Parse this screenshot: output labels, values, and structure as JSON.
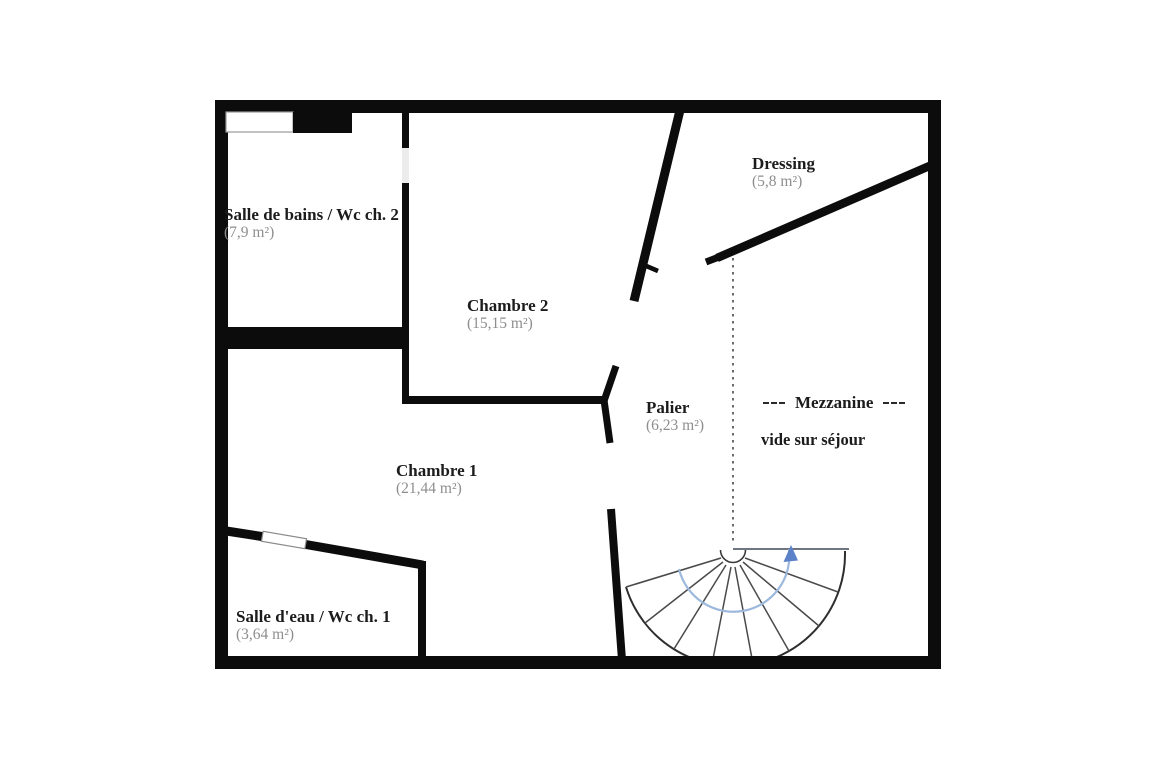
{
  "plan": {
    "type": "floor-plan",
    "floor": "étage (niveau chambres)",
    "rooms": [
      {
        "name": "Salle de bains / Wc ch. 2",
        "area": "(7,9 m²)"
      },
      {
        "name": "Chambre 2",
        "area": "(15,15 m²)"
      },
      {
        "name": "Dressing",
        "area": "(5,8 m²)"
      },
      {
        "name": "Palier",
        "area": "(6,23 m²)"
      },
      {
        "name": "Chambre 1",
        "area": "(21,44 m²)"
      },
      {
        "name": "Salle d'eau / Wc ch. 1",
        "area": "(3,64 m²)"
      }
    ],
    "mezzanine": {
      "label": "Mezzanine",
      "note": "vide sur séjour"
    },
    "stairs": {
      "kind": "quarter-turn fan staircase",
      "direction": "up",
      "steps": 8
    },
    "colors": {
      "wall": "#0c0c0c",
      "room_name_text": "#1c1c1c",
      "room_area_text": "#8e8e8e",
      "stair_outline": "#2e2e2e",
      "stair_step_line": "#4a4a4a",
      "stair_arrow": "#5b82c8",
      "stair_arrow_arc": "#9db8dd",
      "door_opening": "#ececec",
      "background": "#ffffff"
    }
  }
}
